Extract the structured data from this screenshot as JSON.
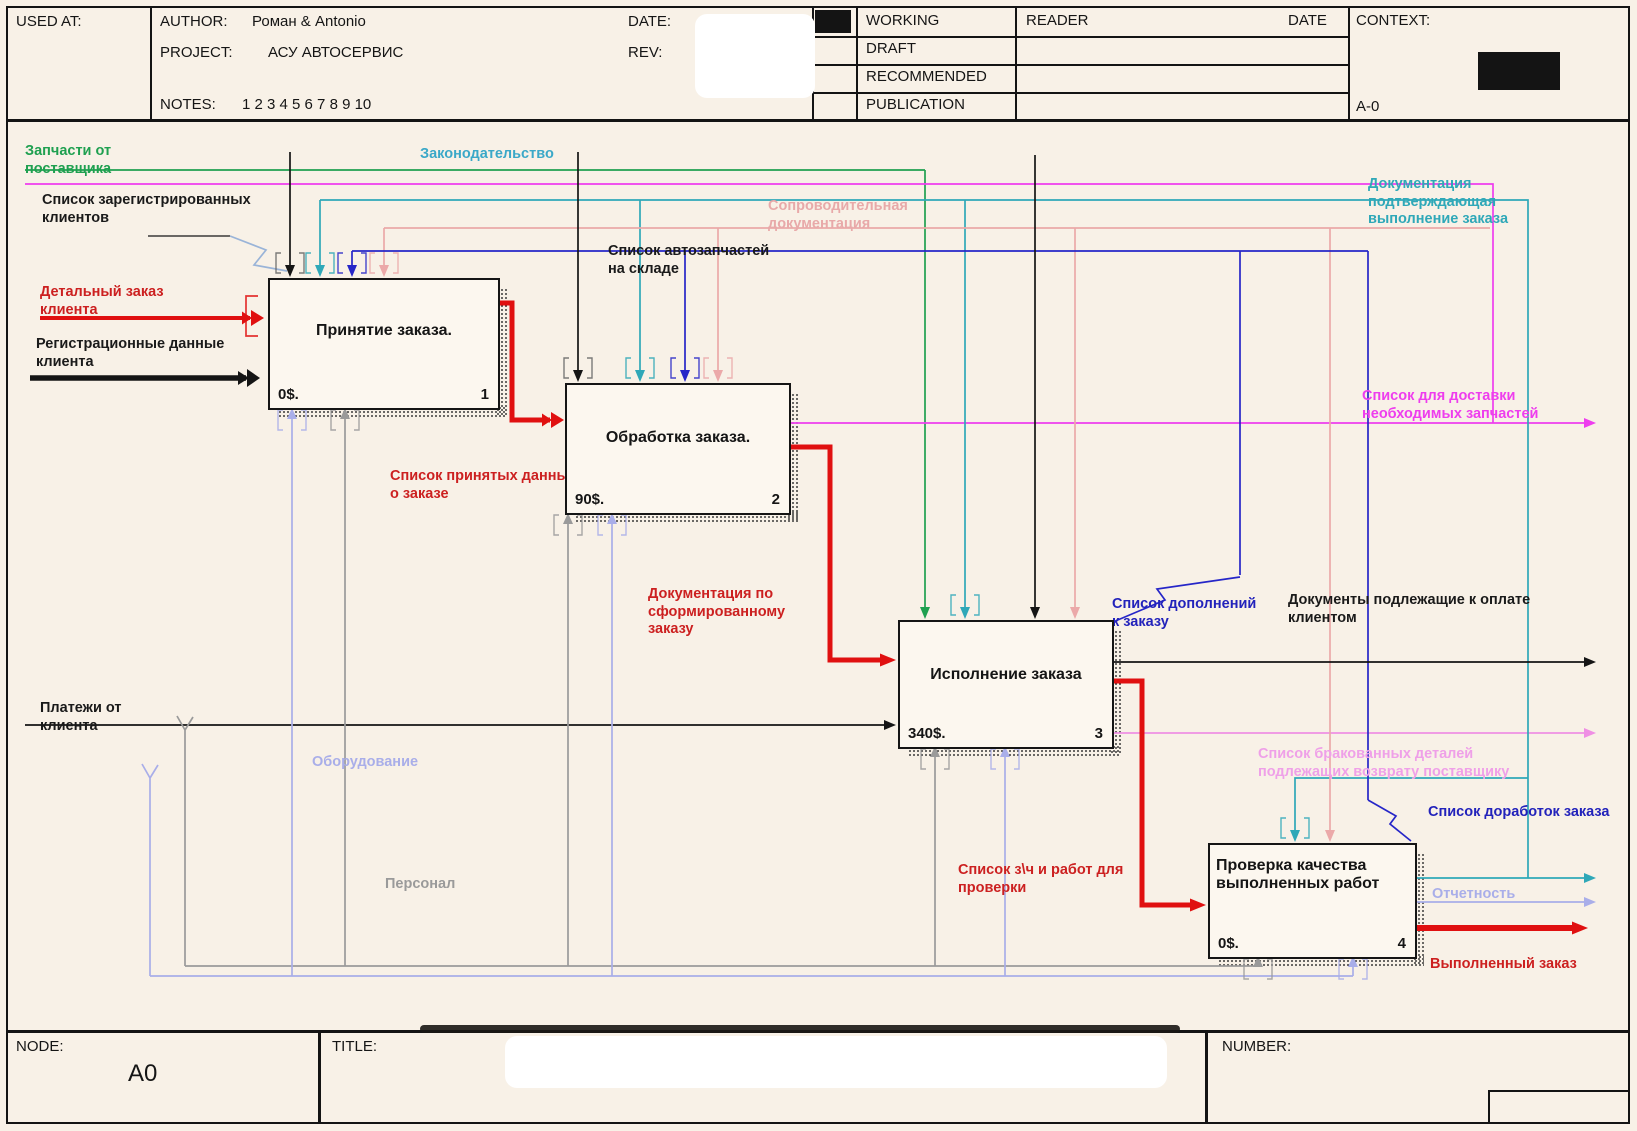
{
  "header": {
    "used_at_label": "USED AT:",
    "author_label": "AUTHOR:",
    "author_value": "Роман & Antonio",
    "project_label": "PROJECT:",
    "project_value": "АСУ АВТОСЕРВИС",
    "date_label": "DATE:",
    "rev_label": "REV:",
    "notes_label": "NOTES:",
    "notes_numbers": "1  2  3  4  5  6  7  8  9  10",
    "status_rows": [
      "WORKING",
      "DRAFT",
      "RECOMMENDED",
      "PUBLICATION"
    ],
    "reader_label": "READER",
    "reader_date_label": "DATE",
    "context_label": "CONTEXT:",
    "context_node": "A-0"
  },
  "footer": {
    "node_label": "NODE:",
    "node_value": "A0",
    "title_label": "TITLE:",
    "number_label": "NUMBER:"
  },
  "activities": [
    {
      "name": "Принятие заказа.",
      "cost": "0$.",
      "number": "1"
    },
    {
      "name": "Обработка заказа.",
      "cost": "90$.",
      "number": "2"
    },
    {
      "name": "Исполнение заказа",
      "cost": "340$.",
      "number": "3"
    },
    {
      "name": "Проверка качества выполненных работ",
      "cost": "0$.",
      "number": "4"
    }
  ],
  "arrow_labels": [
    {
      "text": "Запчасти от поставщика",
      "color": "#1fa050"
    },
    {
      "text": "Список зарегистрированных клиентов",
      "color": "#1a1a1a"
    },
    {
      "text": "Детальный заказ клиента",
      "color": "#cc2020"
    },
    {
      "text": "Регистрационные данные клиента",
      "color": "#1a1a1a"
    },
    {
      "text": "Законодательство",
      "color": "#3aa8c8"
    },
    {
      "text": "Сопроводительная документация",
      "color": "#e8a9a9"
    },
    {
      "text": "Список автозапчастей на складе",
      "color": "#1a1a1a"
    },
    {
      "text": "Список принятых данных о заказе",
      "color": "#cc2020"
    },
    {
      "text": "Документация по сформированному заказу",
      "color": "#cc2020"
    },
    {
      "text": "Документация подтверждающая выполнение заказа",
      "color": "#2fa8b8"
    },
    {
      "text": "Список для доставки необходимых запчастей",
      "color": "#ee3dee"
    },
    {
      "text": "Список дополнений к заказу",
      "color": "#2222bb"
    },
    {
      "text": "Документы подлежащие к оплате клиентом",
      "color": "#1a1a1a"
    },
    {
      "text": "Платежи от клиента",
      "color": "#1a1a1a"
    },
    {
      "text": "Оборудование",
      "color": "#a9aee9"
    },
    {
      "text": "Персонал",
      "color": "#9a9a9a"
    },
    {
      "text": "Список бракованных деталей подлежащих возврату поставщику",
      "color": "#efa0e8"
    },
    {
      "text": "Список доработок заказа",
      "color": "#2222bb"
    },
    {
      "text": "Отчетность",
      "color": "#a9aee9"
    },
    {
      "text": "Список з\\ч и работ для проверки",
      "color": "#cc2020"
    },
    {
      "text": "Выполненный заказ",
      "color": "#cc2020"
    }
  ],
  "colors": {
    "parts_supply": "#1fa050",
    "legislation": "#3aa8c8",
    "feedback_doc": "#2fa8b8",
    "accompanying_doc": "#eba9a9",
    "order_flow": "#e01010",
    "additions_list": "#2626c8",
    "delivery_list": "#ee3dee",
    "defective_list": "#ef8fe4",
    "equipment": "#a9aee9",
    "personnel": "#9a9a9a",
    "ink": "#151515"
  }
}
